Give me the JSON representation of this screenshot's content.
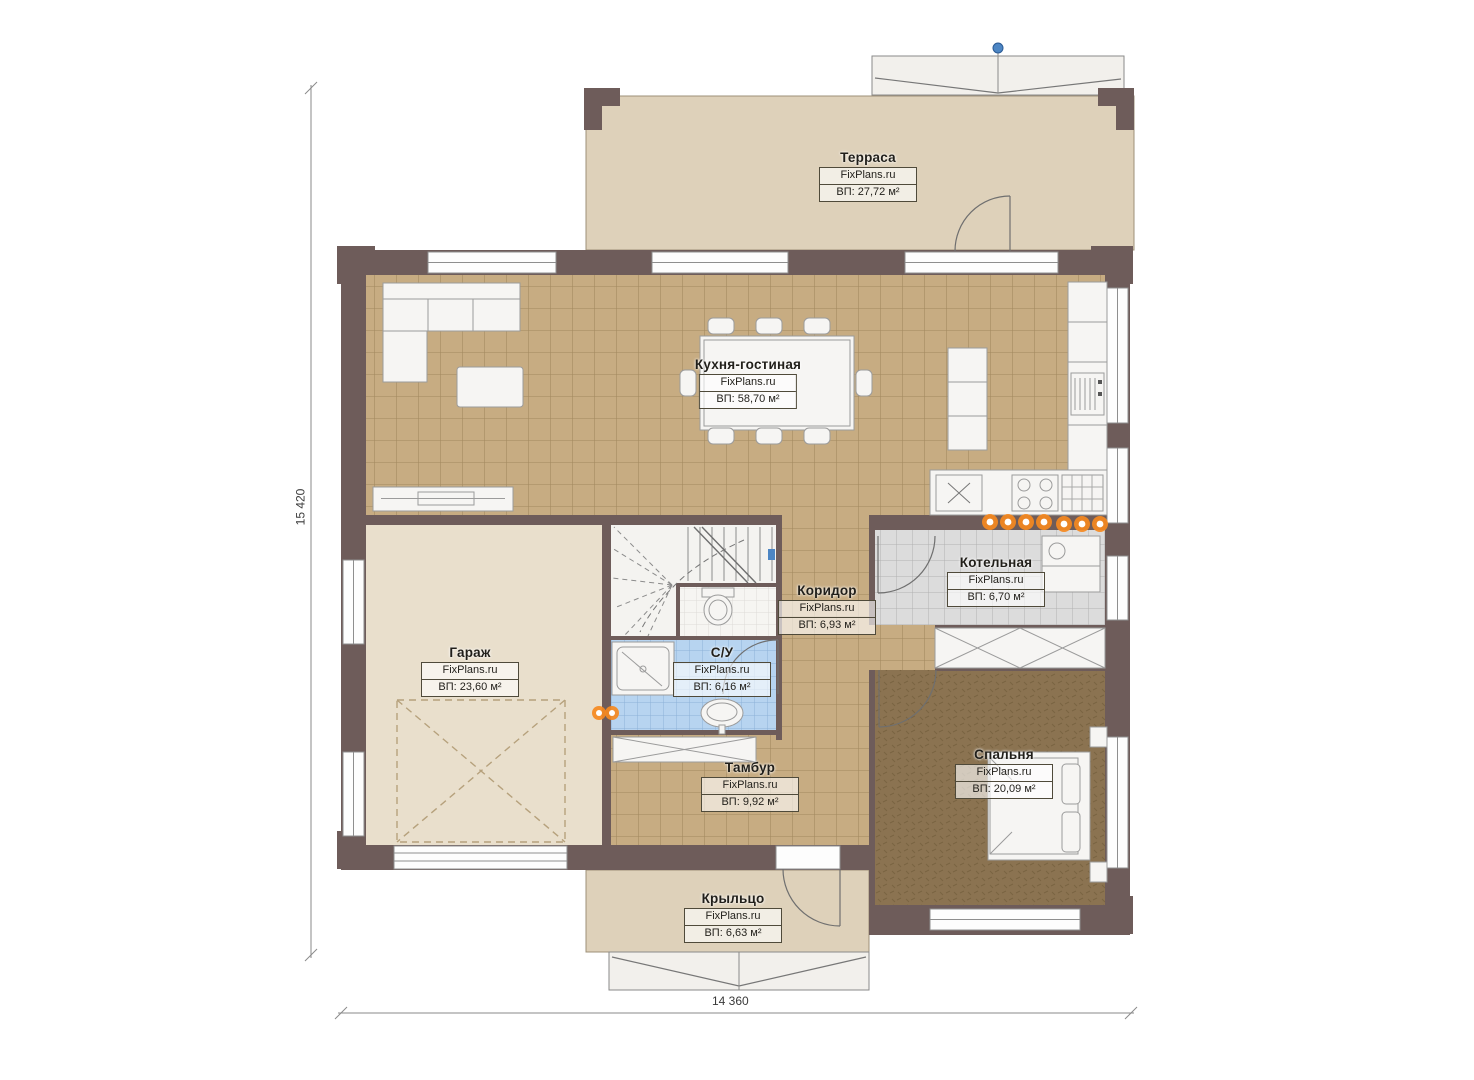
{
  "brand": "FixPlans.ru",
  "plan_dimensions": {
    "height_label": "15 420",
    "width_label": "14 360"
  },
  "rooms": [
    {
      "name": "Терраса",
      "area": "ВП: 27,72 м²"
    },
    {
      "name": "Кухня-гостиная",
      "area": "ВП: 58,70 м²"
    },
    {
      "name": "Гараж",
      "area": "ВП: 23,60 м²"
    },
    {
      "name": "Котельная",
      "area": "ВП: 6,70 м²"
    },
    {
      "name": "Коридор",
      "area": "ВП: 6,93 м²"
    },
    {
      "name": "С/У",
      "area": "ВП: 6,16 м²"
    },
    {
      "name": "Тамбур",
      "area": "ВП: 9,92 м²"
    },
    {
      "name": "Спальня",
      "area": "ВП: 20,09 м²"
    },
    {
      "name": "Крыльцо",
      "area": "ВП: 6,63 м²"
    }
  ],
  "colors": {
    "wall": "#6e5c5a",
    "kitchen_tile": "#c7ac82",
    "terrace_floor": "#ded1ba",
    "garage_floor": "#e9dfcc",
    "boiler_tile": "#dcdcdc",
    "bath_tile": "#b7d4f0",
    "bedroom_carpet": "#8b7351",
    "radiator_marker": "#f5891f",
    "level_marker": "#4d86c4"
  }
}
